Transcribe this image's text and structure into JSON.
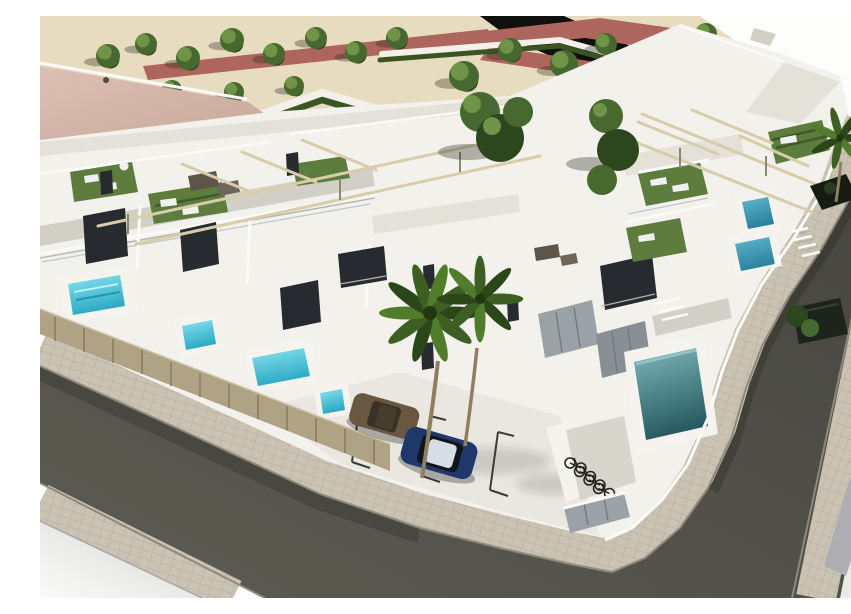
{
  "scene": {
    "title": "Aerial 3D architectural rendering of a modern white residential development",
    "description": "Bird's-eye 3D render: rows of white flat-roofed townhouses with rooftop turf terraces, sun loungers, wicker sofas and wooden pergola beams; private front yards with small cyan plunge pools behind slatted wooden fences; a larger teal pool beside the right street; two palm trees over an inner parking court with a parked brown car and a dark blue car; a corner bicycle rack; a formal park with zigzag hedges, trees, white gravel paths and reddish walkways next to a large pink-roofed building; dark asphalt streets with tiled sidewalks wrap the block with a rounded corner; white background at the edges."
  },
  "colors": {
    "bg": "#fdfdfc",
    "sand": "#e8dcc0",
    "darkArea": "#10100e",
    "redPath": "#ae655e",
    "pathWhite": "#f3f1e9",
    "hedge": "#3a5423",
    "treeDark": "#2c471d",
    "treeMid": "#47682e",
    "treeLight": "#6f9447",
    "shadow": "rgba(35,40,24,0.33)",
    "roofPink": "#dcc0b3",
    "roofPinkD": "#c9a99c",
    "blockWhite": "#f2f1ec",
    "wallShade1": "#e3e1d8",
    "wallShade2": "#d2d0c6",
    "windowDark": "#272a2e",
    "turf": "#5d7c3e",
    "turfDark": "#42592a",
    "lounger": "#f0f1ee",
    "wicker": "#5e554a",
    "wicker2": "#6f6659",
    "courtyard": "#e9e7e0",
    "parkingLine": "#3b3b37",
    "fence": "#b0a285",
    "fenceDark": "#8a7c62",
    "yardShade": "#8a857a",
    "deck": "#f4f3ee",
    "metal": "#9aa1a7",
    "metal2": "#878f95",
    "metalSeam": "#6d757b",
    "parapet": "#fafaf7",
    "edgeShadow": "#b3b0a6",
    "curb": "#8f897c",
    "beam": "#d8cdab",
    "beamShadow": "#8e8671",
    "glassRail": "#b4bfc4",
    "softShadow": "rgba(30,30,28,0.16)",
    "shrubDark": "#161c12",
    "shrubDark2": "#1d241c",
    "bike": "#21211d",
    "road": "#5d5c52",
    "roadDark": "#454440",
    "roadLine": "#e9e9e6",
    "roadStripeGray": "#aeaeb2",
    "sidewalk": "#cac3b4",
    "sidewalkLine": "#b3ac9c",
    "poolLight": "#8ae4f0",
    "poolMid": "#2ba8c3",
    "poolM2a": "#62b9cc",
    "poolM2b": "#27819f",
    "poolTa": "#7fb7ba",
    "poolTb": "#265a60",
    "carBlue": "#20376b",
    "carRoof": "#d8dde5",
    "carGlass": "#10141c",
    "carBrown": "#6a5741",
    "carBrownTop": "#473d2f",
    "swCornerA": "#fafaf9",
    "swCornerB": "#d7d7d4",
    "seCornerA": "#f3f3f2",
    "seCornerB": "#dfdfde"
  }
}
